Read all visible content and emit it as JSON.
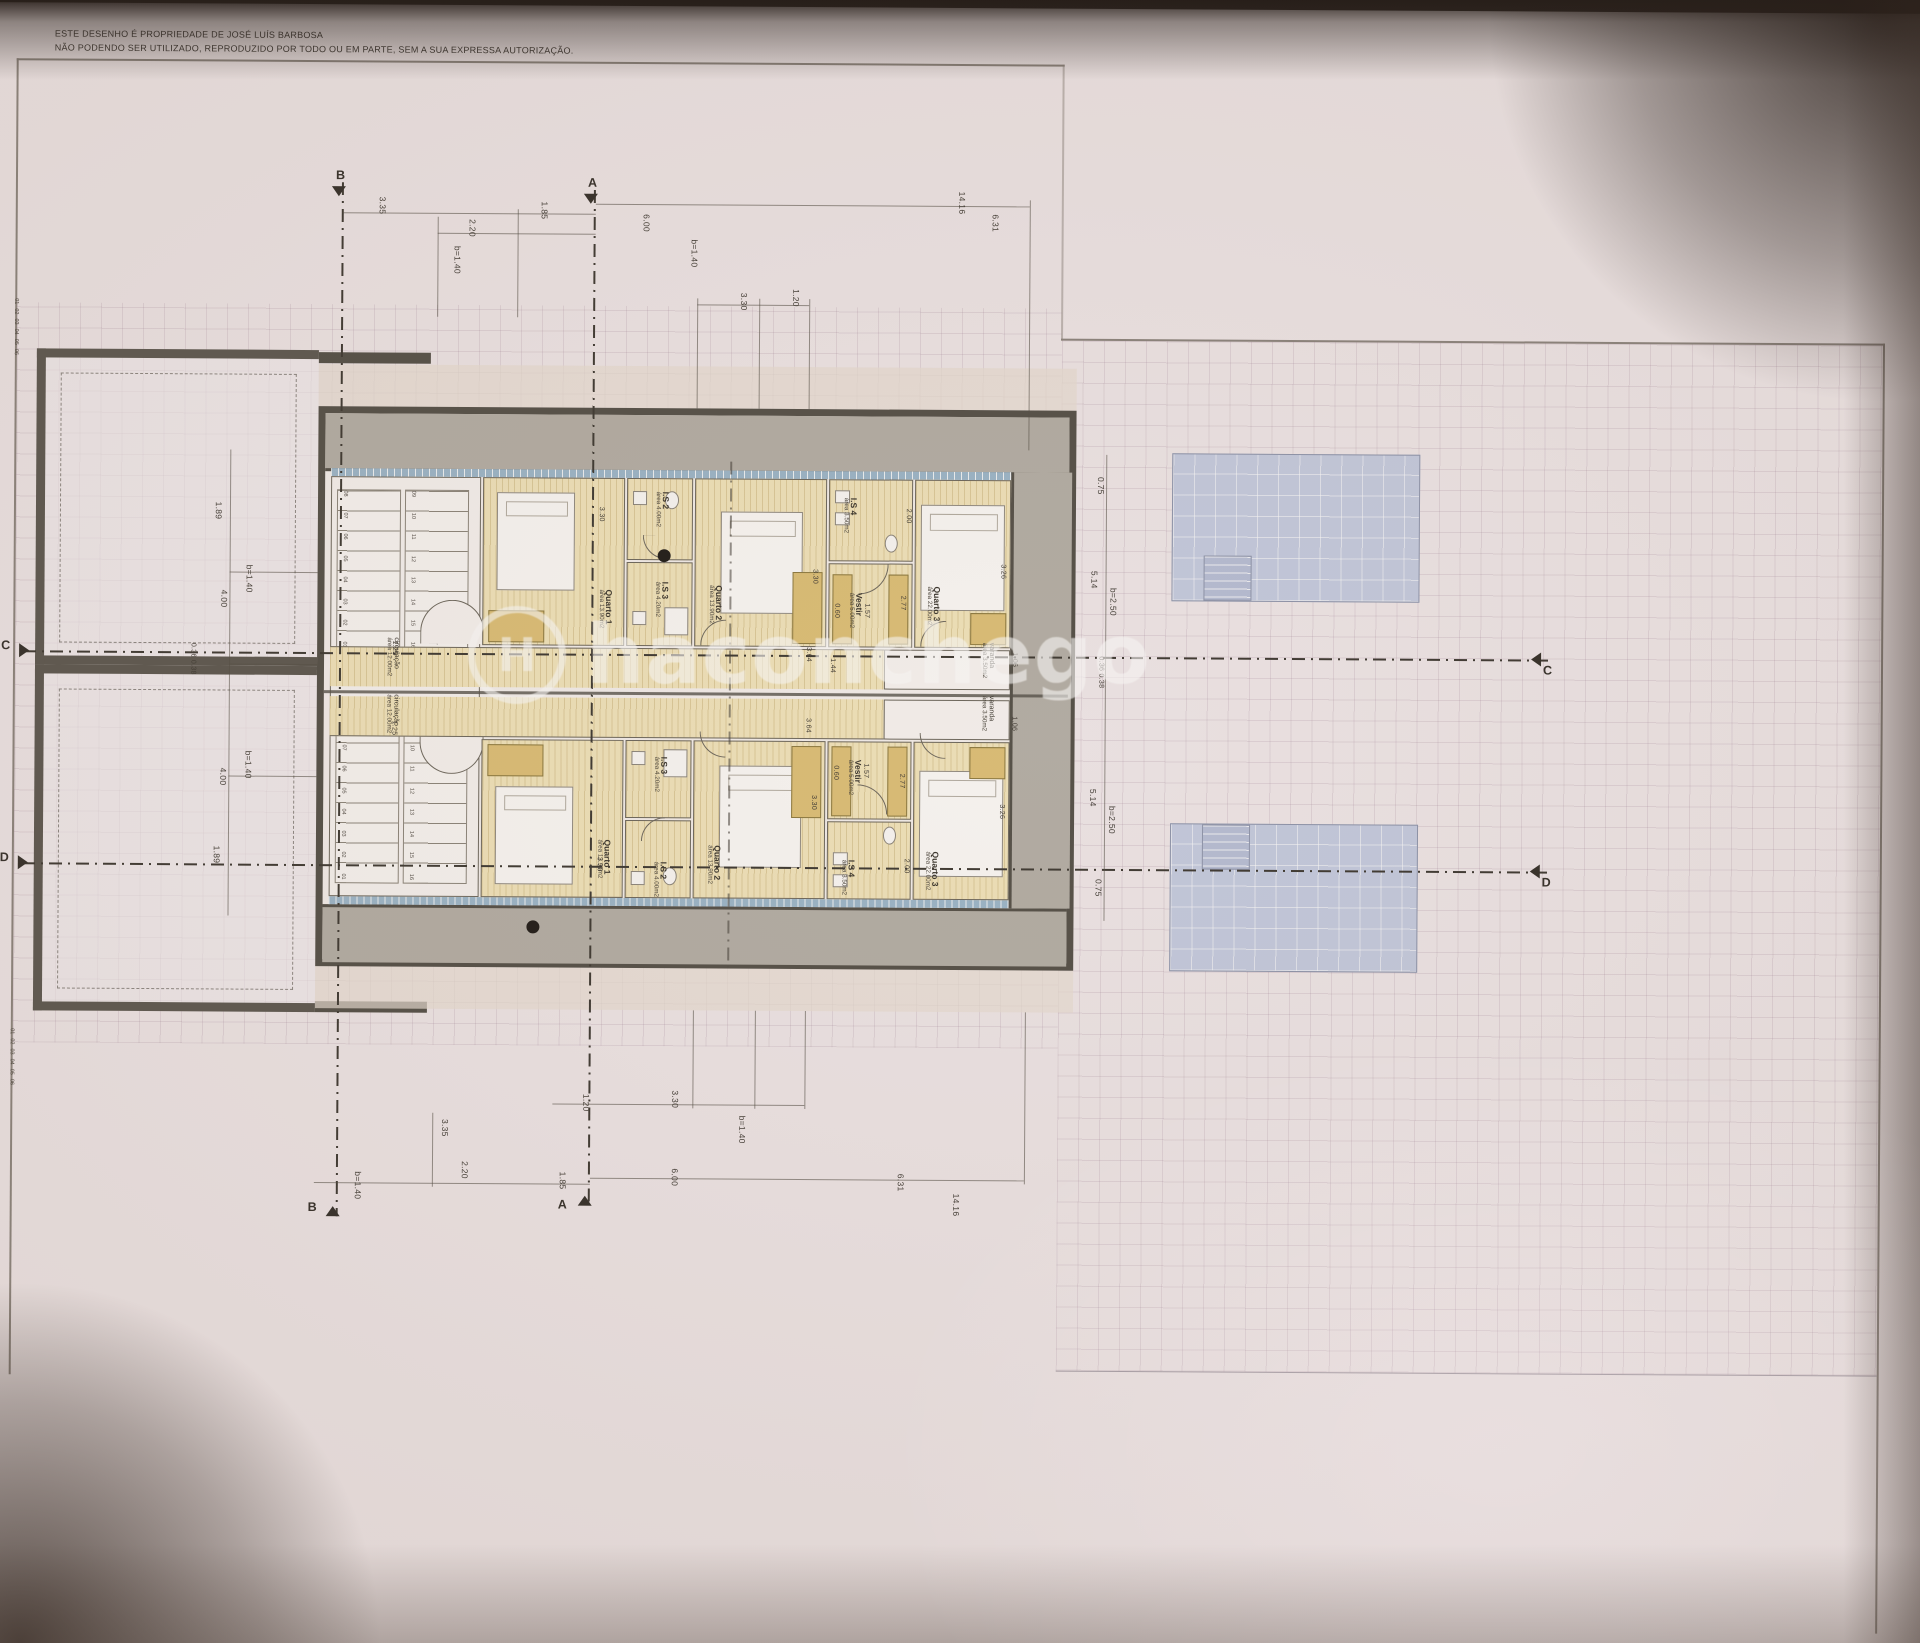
{
  "copyright": {
    "line1": "ESTE DESENHO É PROPRIEDADE DE  JOSÉ LUÍS BARBOSA",
    "line2": "NÃO PODENDO SER UTILIZADO, REPRODUZIDO POR TODO OU EM PARTE, SEM A SUA EXPRESSA AUTORIZAÇÃO."
  },
  "watermark": {
    "logo_letter": "H",
    "text": "haconchego"
  },
  "sections": {
    "a": "A",
    "b": "B",
    "c": "C",
    "d": "D"
  },
  "rooms": {
    "quarto1": {
      "name": "Quarto 1",
      "area": "área 13.90m2"
    },
    "is2": {
      "name": "I.S 2",
      "area": "área 4.00m2"
    },
    "is3": {
      "name": "I.S 3",
      "area": "área 4.20m2"
    },
    "quarto2": {
      "name": "Quarto 2",
      "area": "área 13.90m2"
    },
    "vestir": {
      "name": "Vestir",
      "area": "área 5.00m2"
    },
    "is4": {
      "name": "I.S 4",
      "area": "área 3.50m2"
    },
    "quarto3": {
      "name": "Quarto 3",
      "area": "área 22.00m2"
    },
    "varanda": {
      "name": "varanda",
      "area": "área 3.50m2"
    },
    "circulacao": {
      "name": "circulação",
      "area": "área 12.00m2"
    }
  },
  "dims": {
    "top": [
      "3.35",
      "2.20",
      "b=1.40",
      "1.85",
      "6.00",
      "b=1.40",
      "3.30",
      "1.20",
      "14.16",
      "6.31"
    ],
    "bottom": [
      "3.35",
      "2.20",
      "b=1.40",
      "1.20",
      "3.30",
      "b=1.40",
      "1.85",
      "6.00",
      "6.31",
      "14.16"
    ],
    "left": [
      "1.89",
      "b=1.40",
      "4.00",
      "0.36 0.38",
      "4.00",
      "b=1.40",
      "1.89"
    ],
    "right": [
      "0.75",
      "5.14",
      "b=2.50",
      "0.36 0.38",
      "5.14",
      "b=2.50",
      "0.75"
    ],
    "interior": {
      "q1_w": "3.30",
      "q2_w": "3.30",
      "bed_q2": "3.64",
      "bed_w": "1.44",
      "is4_w": "2.77",
      "is4_d": "2.00",
      "vestir_w": "1.57",
      "wardrobe_d": "0.60",
      "q3_w": "3.26",
      "varanda_w": "1.06",
      "corridor_w": "1.25"
    }
  },
  "stairs": {
    "flight_a": [
      "08",
      "07",
      "06",
      "05",
      "04",
      "03",
      "02",
      "01"
    ],
    "flight_b": [
      "09",
      "10",
      "11",
      "12",
      "13",
      "14",
      "15",
      "16"
    ]
  },
  "edge_marks": [
    "01",
    "02",
    "03",
    "04",
    "05",
    "06"
  ],
  "colors": {
    "sheet": "#f0e8ea",
    "wall": "#55514a",
    "room_fill": "#f2e5bd",
    "furniture": "#dec179",
    "pool": "#c6cde2",
    "terrace_gray": "#b5b0a8",
    "glazing": "#9db8cc",
    "watermark": "#ffffff"
  }
}
